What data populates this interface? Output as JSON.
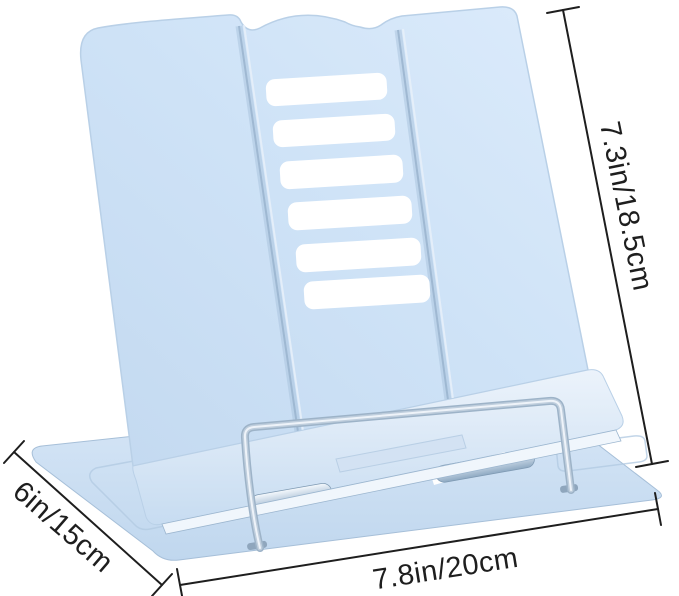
{
  "annotations": {
    "height_label": "7.3in/18.5cm",
    "depth_label": "6in/15cm",
    "width_label": "7.8in/20cm"
  },
  "product": {
    "depicted_object": "metal book reading stand",
    "slot_count": 6
  },
  "colors": {
    "stand_blue": "#cfe3f7",
    "stand_blue_dark": "#a9c3dd",
    "base_blue": "#c8dcf0",
    "wire_gray": "#b7c8d9",
    "annotation_ink": "#1e1e1e",
    "background": "#ffffff"
  }
}
